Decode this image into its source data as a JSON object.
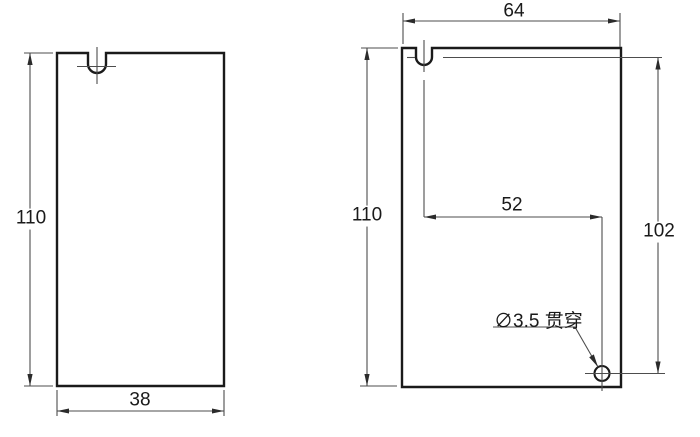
{
  "drawing": {
    "type": "engineering-dimension-drawing",
    "views": {
      "front": {
        "height_dim": "110",
        "width_dim": "38"
      },
      "side": {
        "width_dim": "64",
        "height_dim": "110",
        "hole_horizontal_dim": "52",
        "hole_vertical_dim": "102",
        "hole_callout": "∅3.5 贯穿"
      }
    },
    "colors": {
      "outline": "#1a1a1a",
      "dimension_lines": "#4d4d4d",
      "background": "#ffffff",
      "text": "#1a1a1a"
    }
  }
}
